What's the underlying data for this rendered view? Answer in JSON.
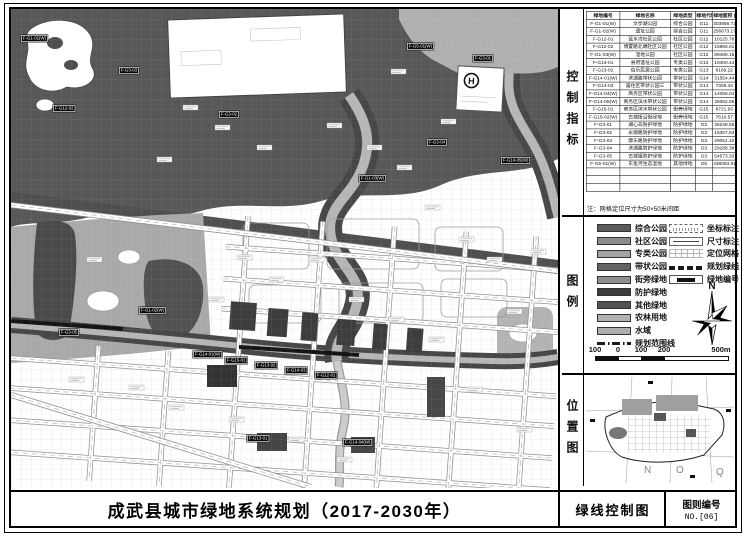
{
  "title_bar": {
    "title": "成武县城市绿地系统规划（2017-2030年）",
    "map_name": "绿线控制图",
    "sheet_label": "图则编号",
    "sheet_no": "NO.[06]"
  },
  "sections": {
    "control": "控制指标",
    "legend": "图例",
    "location": "位置图"
  },
  "table": {
    "headers": [
      "绿地编号",
      "绿地名称",
      "绿地类型",
      "绿地代码",
      "绿地面积 (m²)"
    ],
    "rows": [
      [
        "F-G1-01(W)",
        "文亭湖公园",
        "综合公园",
        "G11",
        "303856.72"
      ],
      [
        "F-G1-02(W)",
        "遗址公园",
        "综合公园",
        "G11",
        "256673.17"
      ],
      [
        "F-G12-01",
        "蓝水湾社区公园",
        "社区公园",
        "G12",
        "10125.78"
      ],
      [
        "F-G12-02",
        "博置路北端社区公园",
        "社区公园",
        "G12",
        "15966.01"
      ],
      [
        "F-G1-03(W)",
        "湿地公园",
        "社区公园",
        "G12",
        "89488.18"
      ],
      [
        "F-G13-01",
        "县府遗址公园",
        "专类公园",
        "G13",
        "10400.44"
      ],
      [
        "F-G13-02",
        "伯乐民居公园",
        "专类公园",
        "G13",
        "8169.22"
      ],
      [
        "F-G14-01(W)",
        "滨湖路带状公园",
        "带状公园",
        "G14",
        "31554.44"
      ],
      [
        "F-G14-03",
        "居住区带状公园三",
        "带状公园",
        "G14",
        "7359.44"
      ],
      [
        "F-G14-04(W)",
        "商务区带状公园",
        "带状公园",
        "G14",
        "14056.04"
      ],
      [
        "F-G14-05(W)",
        "商务区滨水带状公园",
        "带状公园",
        "G14",
        "35062.66"
      ],
      [
        "F-G15-01",
        "商务区滨水带状公园",
        "街旁绿地",
        "G15",
        "8721.93"
      ],
      [
        "F-G15-02(W)",
        "古城街沿街绿地",
        "街旁绿地",
        "G15",
        "7610.57"
      ],
      [
        "F-G3-01",
        "湖心岛防护绿地",
        "防护绿地",
        "G3",
        "35248.55"
      ],
      [
        "F-G3-02",
        "永顺路防护绿地",
        "防护绿地",
        "G3",
        "15367.53"
      ],
      [
        "F-G3-03",
        "康乐路防护绿地",
        "防护绿地",
        "G3",
        "29051.10"
      ],
      [
        "F-G3-04",
        "滨湖路防护绿地",
        "防护绿地",
        "G3",
        "29288.38"
      ],
      [
        "F-G3-05",
        "古城镇防护绿地",
        "防护绿地",
        "G3",
        "54573.33"
      ],
      [
        "F-G5-01(W)",
        "东鱼河生态湿地",
        "其他绿地",
        "G5",
        "438053.91"
      ]
    ],
    "empty_rows": 3,
    "note": "注：网格定位尺寸为50×50米间距"
  },
  "legend": {
    "areas": [
      {
        "label": "综合公园",
        "color": "#5c5c5c"
      },
      {
        "label": "社区公园",
        "color": "#8c8c8c"
      },
      {
        "label": "专类公园",
        "color": "#a2a2a2"
      },
      {
        "label": "带状公园",
        "color": "#636363"
      },
      {
        "label": "街旁绿地",
        "color": "#909090"
      },
      {
        "label": "防护绿地",
        "color": "#3c3c3c"
      },
      {
        "label": "其他绿地",
        "color": "#525252"
      },
      {
        "label": "农林用地",
        "color": "#b2b2b2"
      },
      {
        "label": "水域",
        "color": "#aeaeae"
      }
    ],
    "boundary_label": "规划范围线",
    "symbols": [
      {
        "label": "坐标标注",
        "type": "coord"
      },
      {
        "label": "尺寸标注",
        "type": "dim"
      },
      {
        "label": "定位网格",
        "type": "grid"
      },
      {
        "label": "规划绿线",
        "type": "gline"
      },
      {
        "label": "绿地编号",
        "type": "code"
      }
    ],
    "compass_label": "N",
    "scale": {
      "ticks": [
        "100",
        "0",
        "100",
        "200"
      ],
      "end": "500m"
    }
  },
  "location_map": {
    "letters": [
      "N",
      "O",
      "Q"
    ]
  },
  "map": {
    "h_marker": "H",
    "label_codes": [
      "F-G1-01(W)",
      "F-G3-03",
      "F-G12-02",
      "F-G3-02",
      "F-G5-01(W)",
      "F-G3-01",
      "F-G3-04",
      "F-G1-03(W)",
      "F-G1-02(W)",
      "F-G14-01(W)",
      "F-G15-01",
      "F-G13-02",
      "F-G14-03",
      "F-G12-01",
      "F-G3-05",
      "F-G13-01",
      "F-G14-04(W)",
      "F-G14-05(W)"
    ]
  },
  "colors": {
    "other_green": "#585858",
    "protective_green": "#474747",
    "water": "#b6b6b6",
    "farmland": "#a9a9a9",
    "border": "#000000"
  }
}
